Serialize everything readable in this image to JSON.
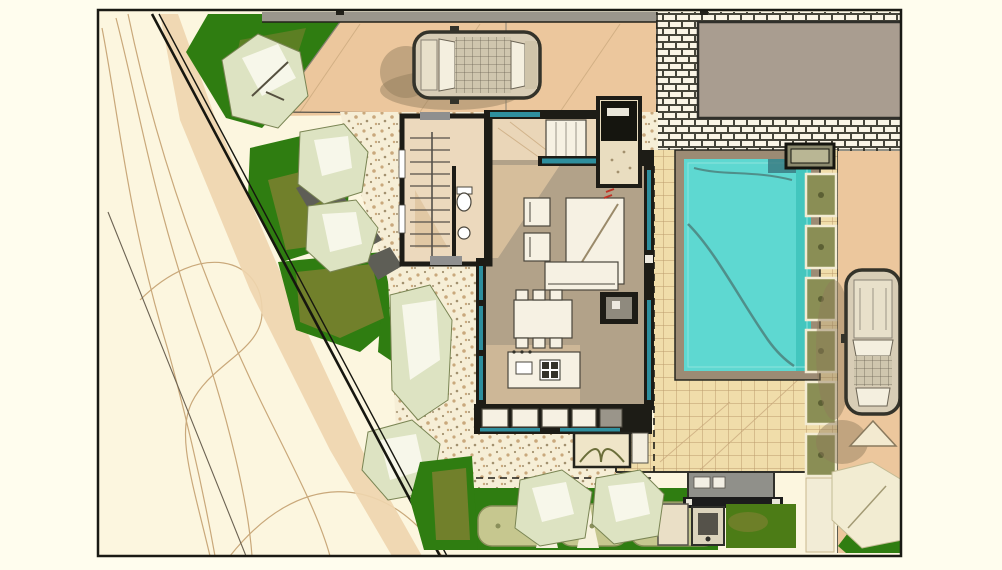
{
  "title": "residential-site-plan-rendering",
  "colors": {
    "page_bg": "#fffdee",
    "terrain": "#fcf6df",
    "contour": "#c9a87a",
    "contour_dark": "#6b6252",
    "tan_band": "#eed5ae",
    "boundary": "#16160f",
    "grass": "#2f7d11",
    "grass_olive": "#7c8030",
    "canopy": "#dde3c2",
    "canopy_edge": "#7a8554",
    "canopy_face": "#f7f7ea",
    "canopy_branch": "#55503f",
    "pebble_bg": "#f6eed6",
    "speckle1": "#c9a87c",
    "speckle2": "#a2906e",
    "driveway": "#ecc79d",
    "drive_line": "#c9a87c",
    "gray_band": "#9a968c",
    "brick_bg": "#faf5e6",
    "brick_line": "#46453a",
    "building": "#a99d90",
    "wall": "#1d1c16",
    "glazing": "#2e8f9e",
    "door_gray": "#8f8f8f",
    "floor_hall": "#ead6b8",
    "floor_wing": "#ecd9bd",
    "floor_main": "#b2a289",
    "floor_light": "#d9c19d",
    "furn": "#f6f1e3",
    "furn_line": "#4a463c",
    "deck_bg": "#f0ddaa",
    "deck_line": "#bb9c6c",
    "pool_border": "#9c8b74",
    "pool_water": "#5ed8d1",
    "pool_deep": "#43c6be",
    "pool_line": "#4f8f8a",
    "pad": "#8a8e55",
    "pad_dark": "#5c6034",
    "pad_edge": "#f3ecd4",
    "hedge": "#c6c78f",
    "hedge_dark": "#8a8f5a",
    "lawn": "#4c7c16",
    "kitchen_gray": "#90908a",
    "bar_dark": "#1c1c1c",
    "car_body": "#d8cdb6",
    "car_trim": "#34332a",
    "car_glass": "#f4efdf",
    "car_roof": "#cfc6ae",
    "car_shadow": "#8d7a5c",
    "marking": "#f3ead0",
    "planter_box": "#efe5c8",
    "red_mark": "#c03325"
  },
  "scene": {
    "type": "architectural site plan, top view, color rendering",
    "plot": "corner plot with diagonal street boundary on the west side and contoured terrain outside",
    "elements": [
      {
        "name": "neighbor-building",
        "desc": "grey building mass, top right, surrounded by brick paving"
      },
      {
        "name": "north-driveway",
        "desc": "tan paved drive along top edge with one parked car"
      },
      {
        "name": "east-driveway",
        "desc": "tan drive on right edge with second parked car and pavement chevron marking"
      },
      {
        "name": "house",
        "desc": "L-shaped villa: stair/bath wing, entry hall with wardrobe, living-dining room, kitchen island, glazed walls (teal)"
      },
      {
        "name": "swimming-pool",
        "desc": "rectangular cyan pool with taupe surround and cleaning-hose squiggle"
      },
      {
        "name": "timber-deck",
        "desc": "gridded terrace between house, pool and drive"
      },
      {
        "name": "planter-pads",
        "desc": "row of 6 olive planter pads east of the pool"
      },
      {
        "name": "garden",
        "desc": "green lawns, sage tree canopies, stepping-stone path, pebble apron around house"
      },
      {
        "name": "outdoor-kitchen",
        "desc": "grey bench with dark bar, bbq box and small lawn at bottom"
      },
      {
        "name": "hedge-row",
        "desc": "clipped shrubs along the south boundary"
      }
    ],
    "counts": {
      "cars": 2,
      "planter_pads": 6,
      "hedge_shrubs": 3,
      "trees": 8
    }
  }
}
